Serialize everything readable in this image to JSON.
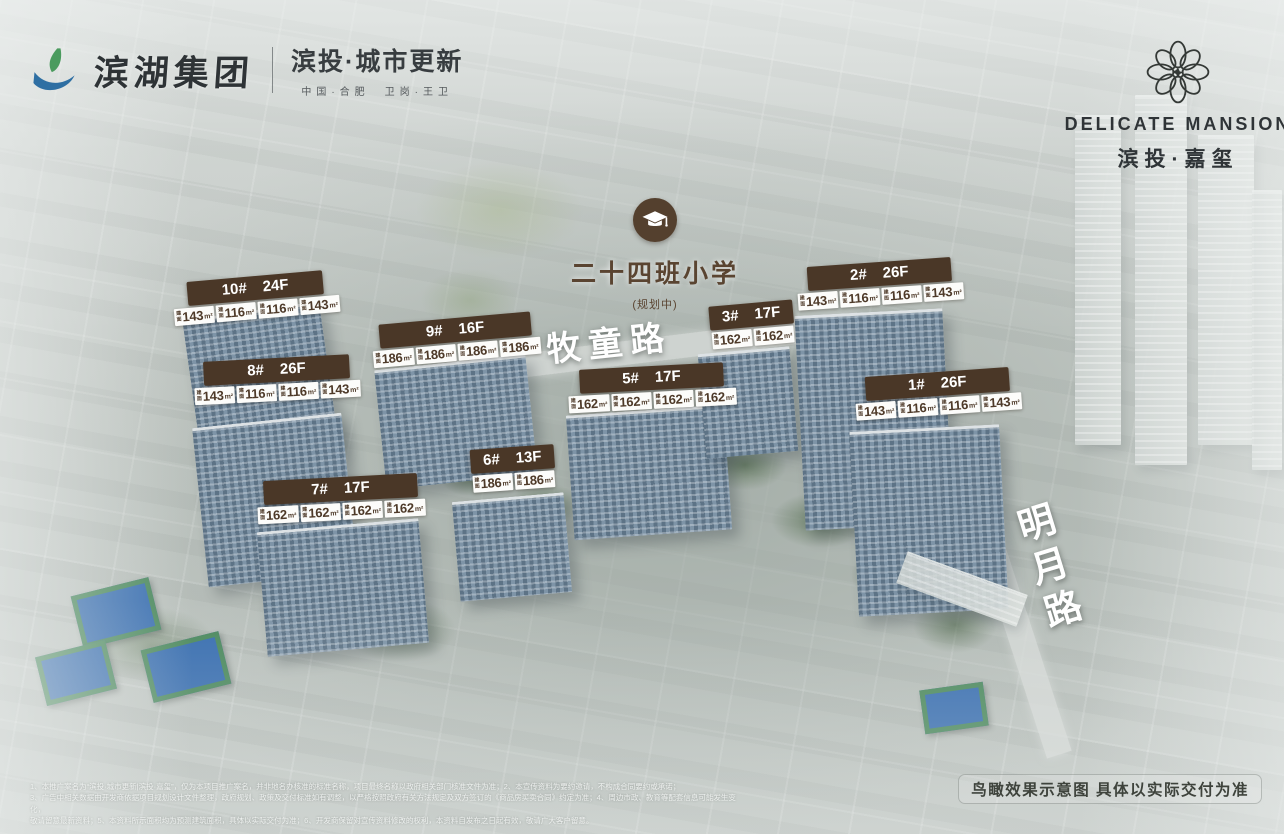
{
  "brand_left": {
    "group_name": "滨湖集团",
    "campaign": "滨投·城市更新",
    "tagline": "中国·合肥　卫岗·王卫"
  },
  "brand_right": {
    "name_en": "DELICATE MANSION",
    "name_cn": "滨投·嘉玺"
  },
  "school": {
    "name": "二十四班小学",
    "status": "(规划中)"
  },
  "roads": [
    {
      "name": "牧童路"
    },
    {
      "name": "明月路"
    }
  ],
  "area_label": {
    "prefix": "建\n面",
    "unit": "m²"
  },
  "buildings": [
    {
      "id": "10#",
      "floors": "24F",
      "units": [
        "143",
        "116",
        "116",
        "143"
      ]
    },
    {
      "id": "9#",
      "floors": "16F",
      "units": [
        "186",
        "186",
        "186",
        "186"
      ]
    },
    {
      "id": "2#",
      "floors": "26F",
      "units": [
        "143",
        "116",
        "116",
        "143"
      ]
    },
    {
      "id": "8#",
      "floors": "26F",
      "units": [
        "143",
        "116",
        "116",
        "143"
      ]
    },
    {
      "id": "3#",
      "floors": "17F",
      "units": [
        "162",
        "162"
      ]
    },
    {
      "id": "5#",
      "floors": "17F",
      "units": [
        "162",
        "162",
        "162",
        "162"
      ]
    },
    {
      "id": "1#",
      "floors": "26F",
      "units": [
        "143",
        "116",
        "116",
        "143"
      ]
    },
    {
      "id": "6#",
      "floors": "13F",
      "units": [
        "186",
        "186"
      ]
    },
    {
      "id": "7#",
      "floors": "17F",
      "units": [
        "162",
        "162",
        "162",
        "162"
      ]
    }
  ],
  "footer": {
    "disclaimer_lines": [
      "1、本推广案名为“滨投·城市更新|滨投·嘉玺”，仅为本项目推广案名，并非地名办核准的标准名称，项目最终名称以政府相关部门核准文件为准；2、本宣传资料为要约邀请，不构成合同要约或承诺；",
      "3、广告中相关数据由开发商依据项目规划设计文件整理，政府规划、政策及交付标准如有调整，以严格按照政府有关方法规定及双方签订的《商品房买卖合同》约定为准；4、周边市政、教育等配套信息可能发生变化，",
      "敬请留意最新资料；5、本资料所示面积均为预测建筑面积，具体以实际交付为准；6、开发商保留对宣传资料修改的权利，本资料自发布之日起有效，敬请广大客户留意。"
    ],
    "note": "鸟瞰效果示意图  具体以实际交付为准"
  },
  "colors": {
    "label_bg": "#4a3727",
    "label_text": "#ffffff",
    "area_text": "#4e3a29",
    "brand_dark": "#2f3437",
    "school_brown": "#5a4431",
    "road_text": "#ffffff",
    "logo_leaf_green": "#4a9b5e",
    "logo_wave_blue": "#2e6fa3"
  }
}
